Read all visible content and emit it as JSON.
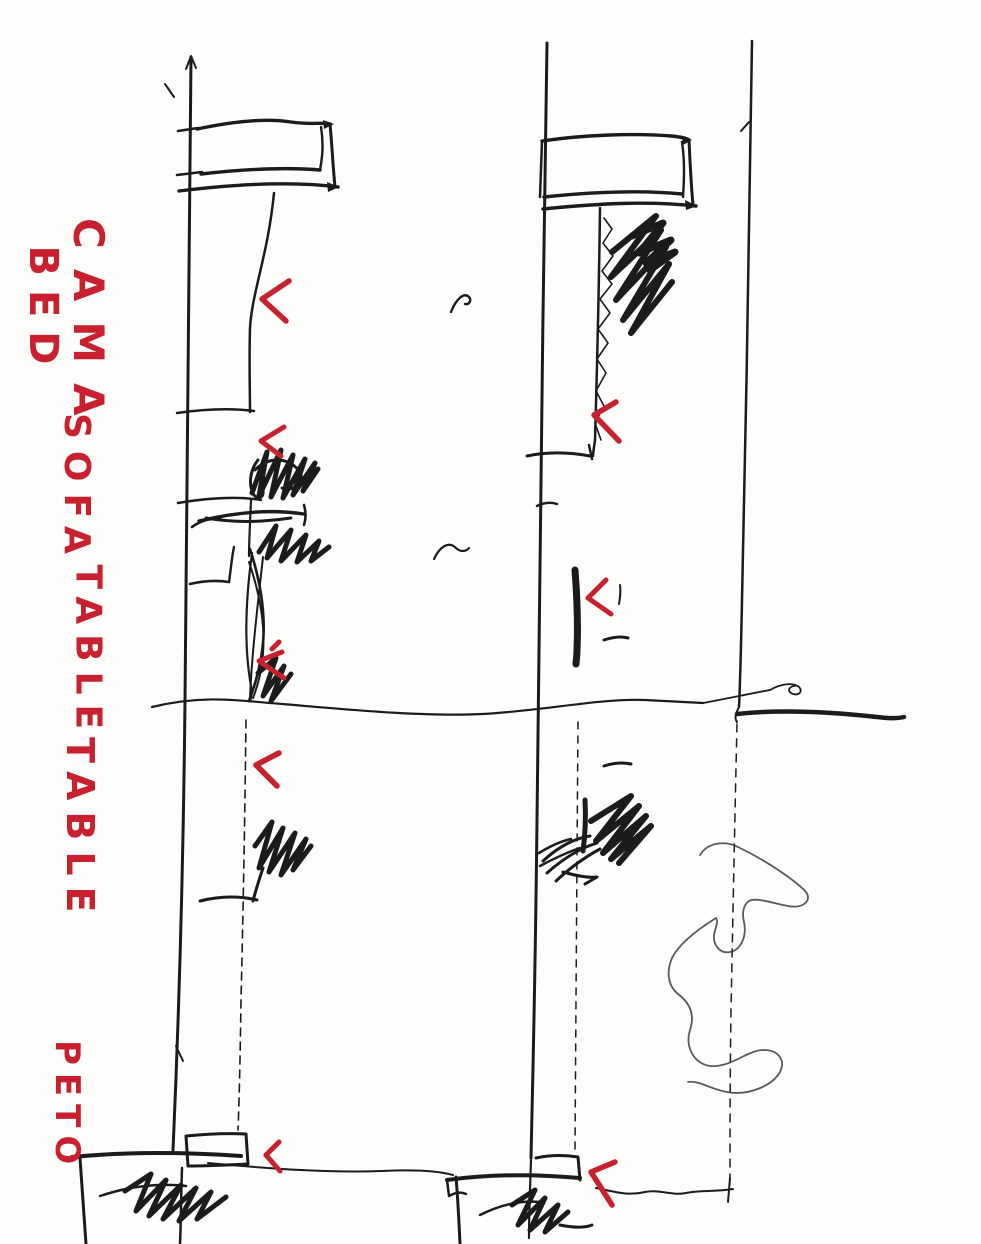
{
  "labels": {
    "bed_spanish": "CAMA",
    "bed_english": "BED",
    "sofa": "SOFA",
    "table_upper": "TABLE",
    "table_lower": "TABLE",
    "parapet": "PETO"
  },
  "colors": {
    "paper": "#fdfdfc",
    "ink": "#1b1b1b",
    "annotation_red": "#c8202f"
  },
  "annotations": {
    "checkmark_count": 8,
    "squiggle_count": 2
  }
}
